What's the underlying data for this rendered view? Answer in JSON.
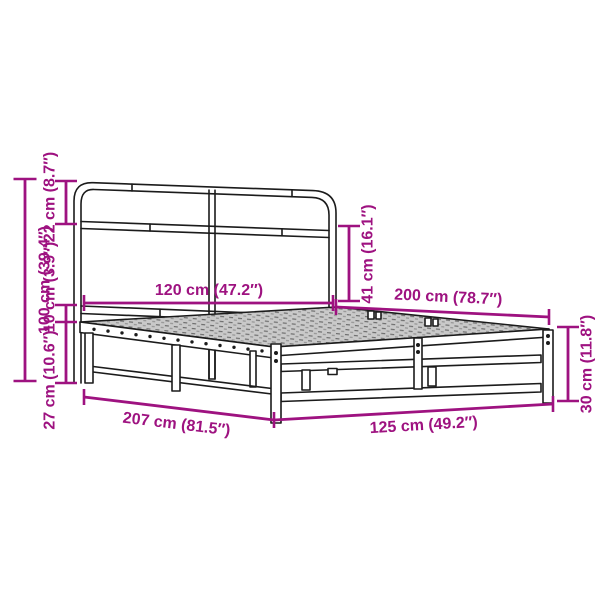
{
  "drawing": {
    "description": "Technical dimension diagram of a metal bed frame with headboard (no mattress)",
    "colors": {
      "dimension": "#9E1280",
      "outline": "#1B1B1B",
      "background": "#FFFFFF",
      "platform": "#C9C9C9"
    },
    "dims": {
      "total_height": "100 cm (39.4″)",
      "headboard_top_section": "22 cm (8.7″)",
      "rail_above_base": "10 cm (3.9″)",
      "under_bed_clearance": "27 cm (10.6″)",
      "headboard_width": "120 cm (47.2″)",
      "headboard_above_platform": "41 cm (16.1″)",
      "sleeping_length": "200 cm (78.7″)",
      "base_height": "30 cm (11.8″)",
      "total_length": "207 cm (81.5″)",
      "total_width": "125 cm (49.2″)"
    }
  }
}
